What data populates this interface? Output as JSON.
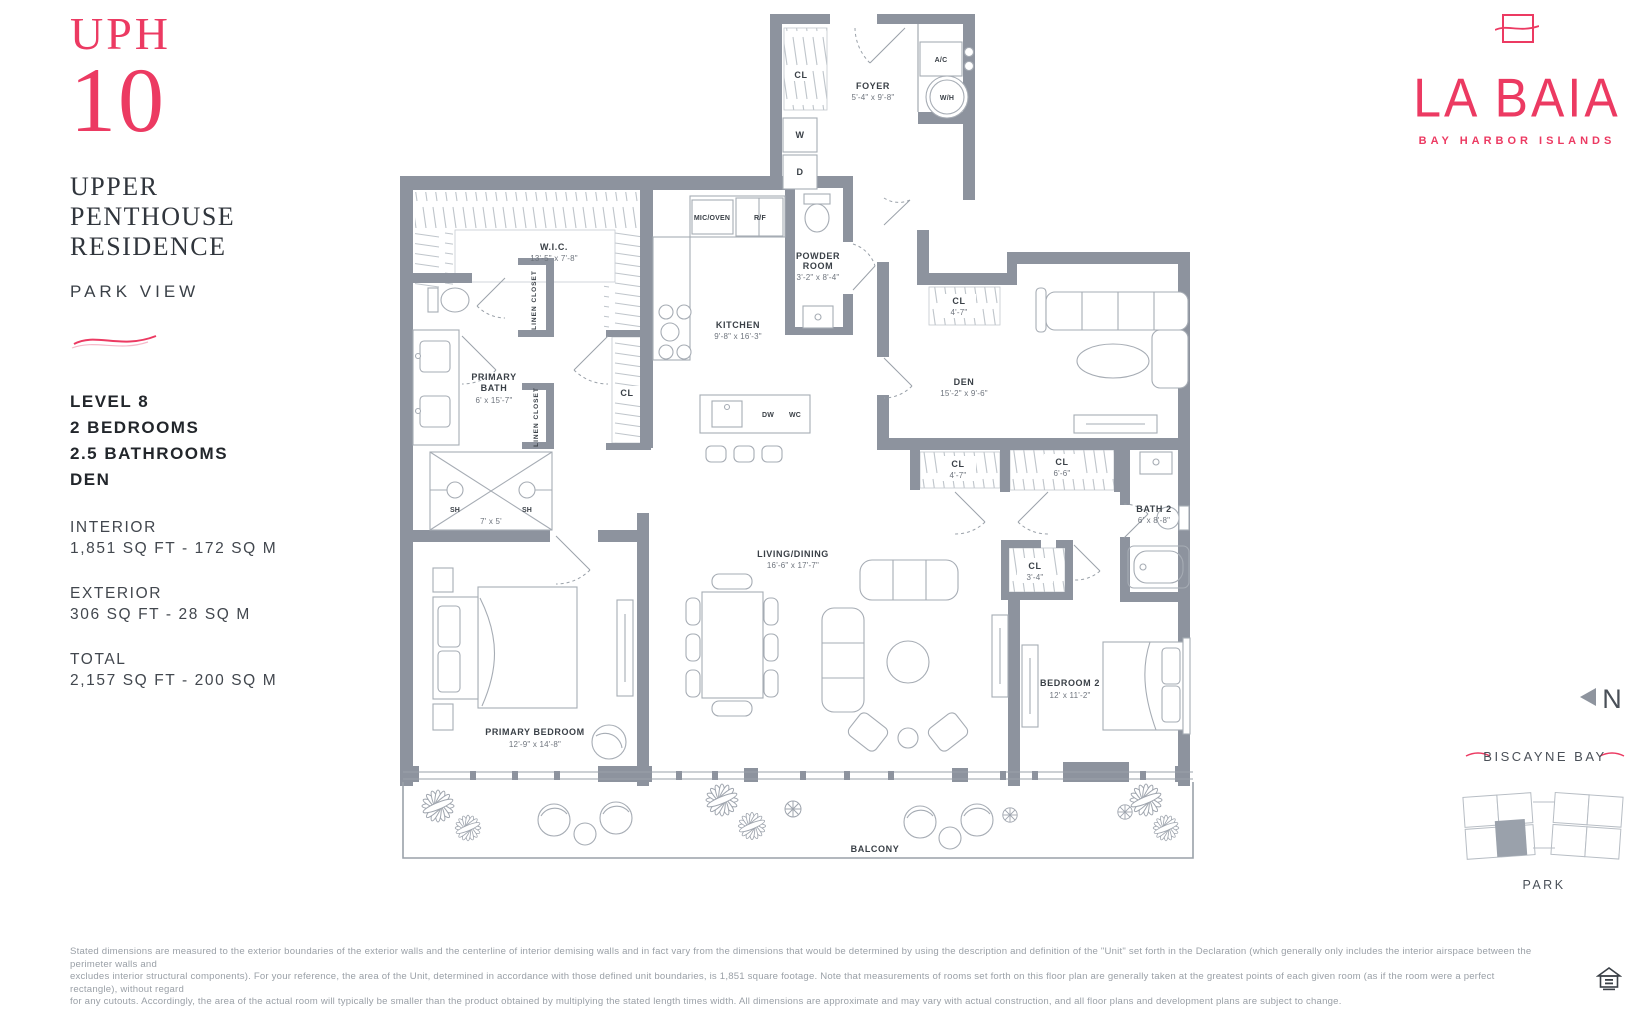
{
  "sidebar": {
    "unit_label": "UPH",
    "unit_number": "10",
    "residence_line1": "UPPER",
    "residence_line2": "PENTHOUSE",
    "residence_line3": "RESIDENCE",
    "view_label": "PARK VIEW",
    "spec_line1": "LEVEL 8",
    "spec_line2": "2 BEDROOMS",
    "spec_line3": "2.5 BATHROOMS",
    "spec_line4": "DEN",
    "interior_label": "INTERIOR",
    "interior_value": "1,851 SQ FT - 172 SQ M",
    "exterior_label": "EXTERIOR",
    "exterior_value": "306 SQ FT - 28 SQ M",
    "total_label": "TOTAL",
    "total_value": "2,157 SQ FT - 200 SQ M"
  },
  "brand": {
    "wordmark": "LA BAIA",
    "tagline": "BAY HARBOR ISLANDS",
    "accent_color": "#EC3A62"
  },
  "keyplan": {
    "north_label": "N",
    "water_label": "BISCAYNE BAY",
    "park_label": "PARK"
  },
  "plan": {
    "foyer_name": "FOYER",
    "foyer_dims": "5'-4\" x 9'-8\"",
    "cl": "CL",
    "washer": "W",
    "dryer": "D",
    "ac": "A/C",
    "water_heater": "W/H",
    "mic_oven": "MIC/OVEN",
    "fridge": "R/F",
    "powder_line1": "POWDER",
    "powder_line2": "ROOM",
    "powder_dims": "3'-2\" x 8'-4\"",
    "wic_name": "W.I.C.",
    "wic_dims": "13'-5\" x 7'-8\"",
    "kitchen_name": "KITCHEN",
    "kitchen_dims": "9'-8\" x 16'-3\"",
    "linen_closet": "LINEN CLOSET",
    "primary_bath_line1": "PRIMARY",
    "primary_bath_line2": "BATH",
    "primary_bath_dims": "6' x 15'-7\"",
    "shower_head": "SH",
    "shower_dims": "7' x 5'",
    "dishwasher": "DW",
    "wine_cooler": "WC",
    "den_name": "DEN",
    "den_dims": "15'-2\" x 9'-6\"",
    "cl_den_dims": "4'-7\"",
    "cl_row1_dims": "4'-7\"",
    "cl_row2_dims": "6'-6\"",
    "cl_small_dims": "3'-4\"",
    "bath2_name": "BATH 2",
    "bath2_dims": "6' x 8'-8\"",
    "living_name": "LIVING/DINING",
    "living_dims": "16'-6\" x 17'-7\"",
    "primary_bedroom_name": "PRIMARY BEDROOM",
    "primary_bedroom_dims": "12'-9\" x 14'-8\"",
    "bedroom2_name": "BEDROOM 2",
    "bedroom2_dims": "12' x 11'-2\"",
    "balcony_name": "BALCONY"
  },
  "disclaimer": {
    "line1": "Stated dimensions are measured to the exterior boundaries of the exterior walls and the centerline of interior demising walls and in fact vary from the dimensions that would be determined by using the description and definition of the \"Unit\" set forth in the Declaration (which generally only includes the interior airspace between the perimeter walls and",
    "line2": "excludes interior structural components).  For your reference, the area of the Unit, determined in accordance with those defined unit boundaries, is 1,851 square footage. Note that measurements of rooms set forth on this floor plan are generally taken at the greatest points of each given room (as if the room were a perfect rectangle), without regard",
    "line3": "for any cutouts. Accordingly, the area of the actual room will typically be smaller than the product obtained by multiplying the stated length times width. All dimensions are approximate and may vary with actual construction, and all floor plans and development plans are subject to change."
  },
  "colors": {
    "wall": "#8D939E",
    "accent": "#EC3A62"
  }
}
